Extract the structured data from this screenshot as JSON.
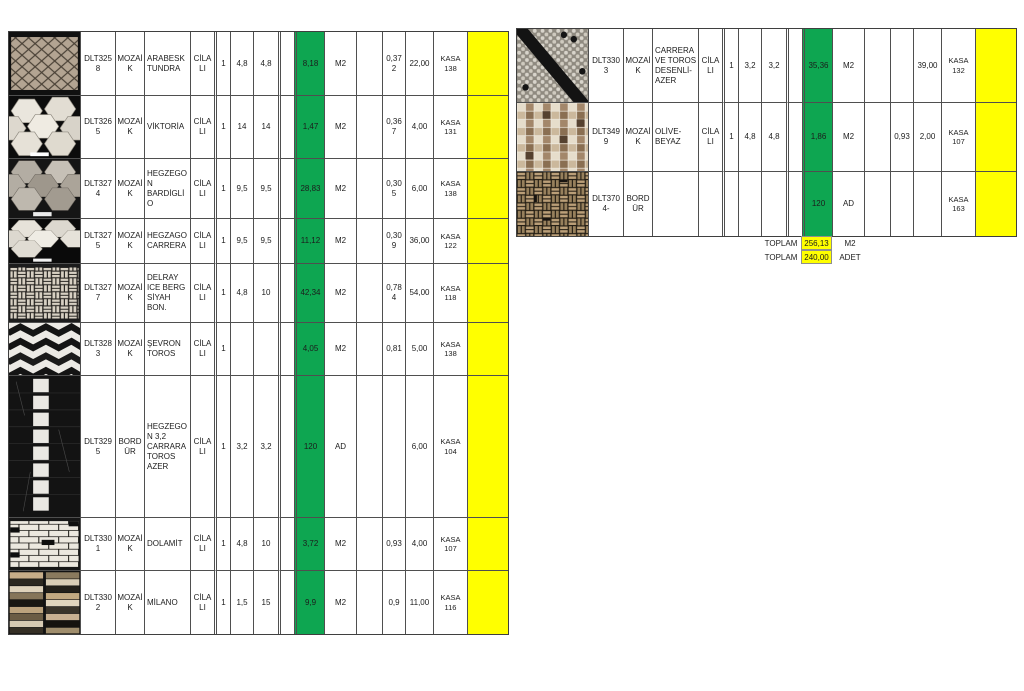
{
  "colors": {
    "green": "#0EA651",
    "yellow": "#FFFF00",
    "border": "#4f4f4f"
  },
  "left_table": {
    "rows": [
      {
        "photo": "arabesk-mosaic-beige",
        "code": "DLT3258",
        "type": "MOZAİK",
        "name": "ARABESK TUNDRA",
        "finish": "CİLALI",
        "qty": "1",
        "dim1": "4,8",
        "dim2": "4,8",
        "blank": "",
        "amount": "8,18",
        "unit": "M2",
        "spacer": "",
        "coef": "0,372",
        "count": "22,00",
        "kasa": "KASA 138",
        "highlight": ""
      },
      {
        "photo": "large-white-hexagon-mosaic",
        "code": "DLT3265",
        "type": "MOZAİK",
        "name": "VİKTORİA",
        "finish": "CİLALI",
        "qty": "1",
        "dim1": "14",
        "dim2": "14",
        "blank": "",
        "amount": "1,47",
        "unit": "M2",
        "spacer": "",
        "coef": "0,367",
        "count": "4,00",
        "kasa": "KASA 131",
        "highlight": ""
      },
      {
        "photo": "gray-hexagon-mosaic",
        "code": "DLT3274",
        "type": "MOZAİK",
        "name": "HEGZEGON BARDİGLİO",
        "finish": "CİLALI",
        "qty": "1",
        "dim1": "9,5",
        "dim2": "9,5",
        "blank": "",
        "amount": "28,83",
        "unit": "M2",
        "spacer": "",
        "coef": "0,305",
        "count": "6,00",
        "kasa": "KASA 138",
        "highlight": ""
      },
      {
        "photo": "white-hexagon-mosaic",
        "code": "DLT3275",
        "type": "MOZAİK",
        "name": "HEGZAGO CARRERA",
        "finish": "CİLALI",
        "qty": "1",
        "dim1": "9,5",
        "dim2": "9,5",
        "blank": "",
        "amount": "11,12",
        "unit": "M2",
        "spacer": "",
        "coef": "0,309",
        "count": "36,00",
        "kasa": "KASA 122",
        "highlight": ""
      },
      {
        "photo": "basketweave-light-mosaic",
        "code": "DLT3277",
        "type": "MOZAİK",
        "name": "DELRAY ICE BERG SİYAH BON.",
        "finish": "CİLALI",
        "qty": "1",
        "dim1": "4,8",
        "dim2": "10",
        "blank": "",
        "amount": "42,34",
        "unit": "M2",
        "spacer": "",
        "coef": "0,784",
        "count": "54,00",
        "kasa": "KASA 118",
        "highlight": ""
      },
      {
        "photo": "black-white-chevron-mosaic",
        "code": "DLT3283",
        "type": "MOZAİK",
        "name": "ŞEVRON TOROS",
        "finish": "CİLALI",
        "qty": "1",
        "dim1": "",
        "dim2": "",
        "blank": "",
        "amount": "4,05",
        "unit": "M2",
        "spacer": "",
        "coef": "0,81",
        "count": "5,00",
        "kasa": "KASA 138",
        "highlight": ""
      },
      {
        "photo": "black-marble-border-strip",
        "code": "DLT3295",
        "type": "BORDÜR",
        "name": "HEGZEGON 3,2 CARRARA TOROS AZER",
        "finish": "CİLALI",
        "qty": "1",
        "dim1": "3,2",
        "dim2": "3,2",
        "blank": "",
        "amount": "120",
        "unit": "AD",
        "spacer": "",
        "coef": "",
        "count": "6,00",
        "kasa": "KASA 104",
        "highlight": ""
      },
      {
        "photo": "white-brick-mosaic",
        "code": "DLT3301",
        "type": "MOZAİK",
        "name": "DOLAMİT",
        "finish": "CİLALI",
        "qty": "1",
        "dim1": "4,8",
        "dim2": "10",
        "blank": "",
        "amount": "3,72",
        "unit": "M2",
        "spacer": "",
        "coef": "0,93",
        "count": "4,00",
        "kasa": "KASA 107",
        "highlight": ""
      },
      {
        "photo": "beige-brown-strip-mosaic",
        "code": "DLT3302",
        "type": "MOZAİK",
        "name": "MİLANO",
        "finish": "CİLALI",
        "qty": "1",
        "dim1": "1,5",
        "dim2": "15",
        "blank": "",
        "amount": "9,9",
        "unit": "M2",
        "spacer": "",
        "coef": "0,9",
        "count": "11,00",
        "kasa": "KASA 116",
        "highlight": ""
      }
    ]
  },
  "right_table": {
    "rows": [
      {
        "photo": "small-hexagon-mosaic-diagonal-black",
        "code": "DLT3303",
        "type": "MOZAİK",
        "name": "CARRERA VE TOROS DESENLİ-AZER",
        "finish": "CİLALI",
        "qty": "1",
        "dim1": "3,2",
        "dim2": "3,2",
        "blank": "",
        "amount": "35,36",
        "unit": "M2",
        "spacer": "",
        "coef": "",
        "count": "39,00",
        "kasa": "KASA 132",
        "highlight": ""
      },
      {
        "photo": "small-square-mosaic-cream-brown",
        "code": "DLT3499",
        "type": "MOZAİK",
        "name": "OLİVE-BEYAZ",
        "finish": "CİLALI",
        "qty": "1",
        "dim1": "4,8",
        "dim2": "4,8",
        "blank": "",
        "amount": "1,86",
        "unit": "M2",
        "spacer": "",
        "coef": "0,93",
        "count": "2,00",
        "kasa": "KASA 107",
        "highlight": ""
      },
      {
        "photo": "basketweave-brown-border",
        "code": "DLT3704-",
        "type": "BORDÜR",
        "name": "",
        "finish": "",
        "qty": "",
        "dim1": "",
        "dim2": "",
        "blank": "",
        "amount": "120",
        "unit": "AD",
        "spacer": "",
        "coef": "",
        "count": "",
        "kasa": "KASA 163",
        "highlight": ""
      }
    ]
  },
  "totals": [
    {
      "label": "TOPLAM",
      "value": "256,13",
      "unit": "M2"
    },
    {
      "label": "TOPLAM",
      "value": "240,00",
      "unit": "ADET"
    }
  ]
}
